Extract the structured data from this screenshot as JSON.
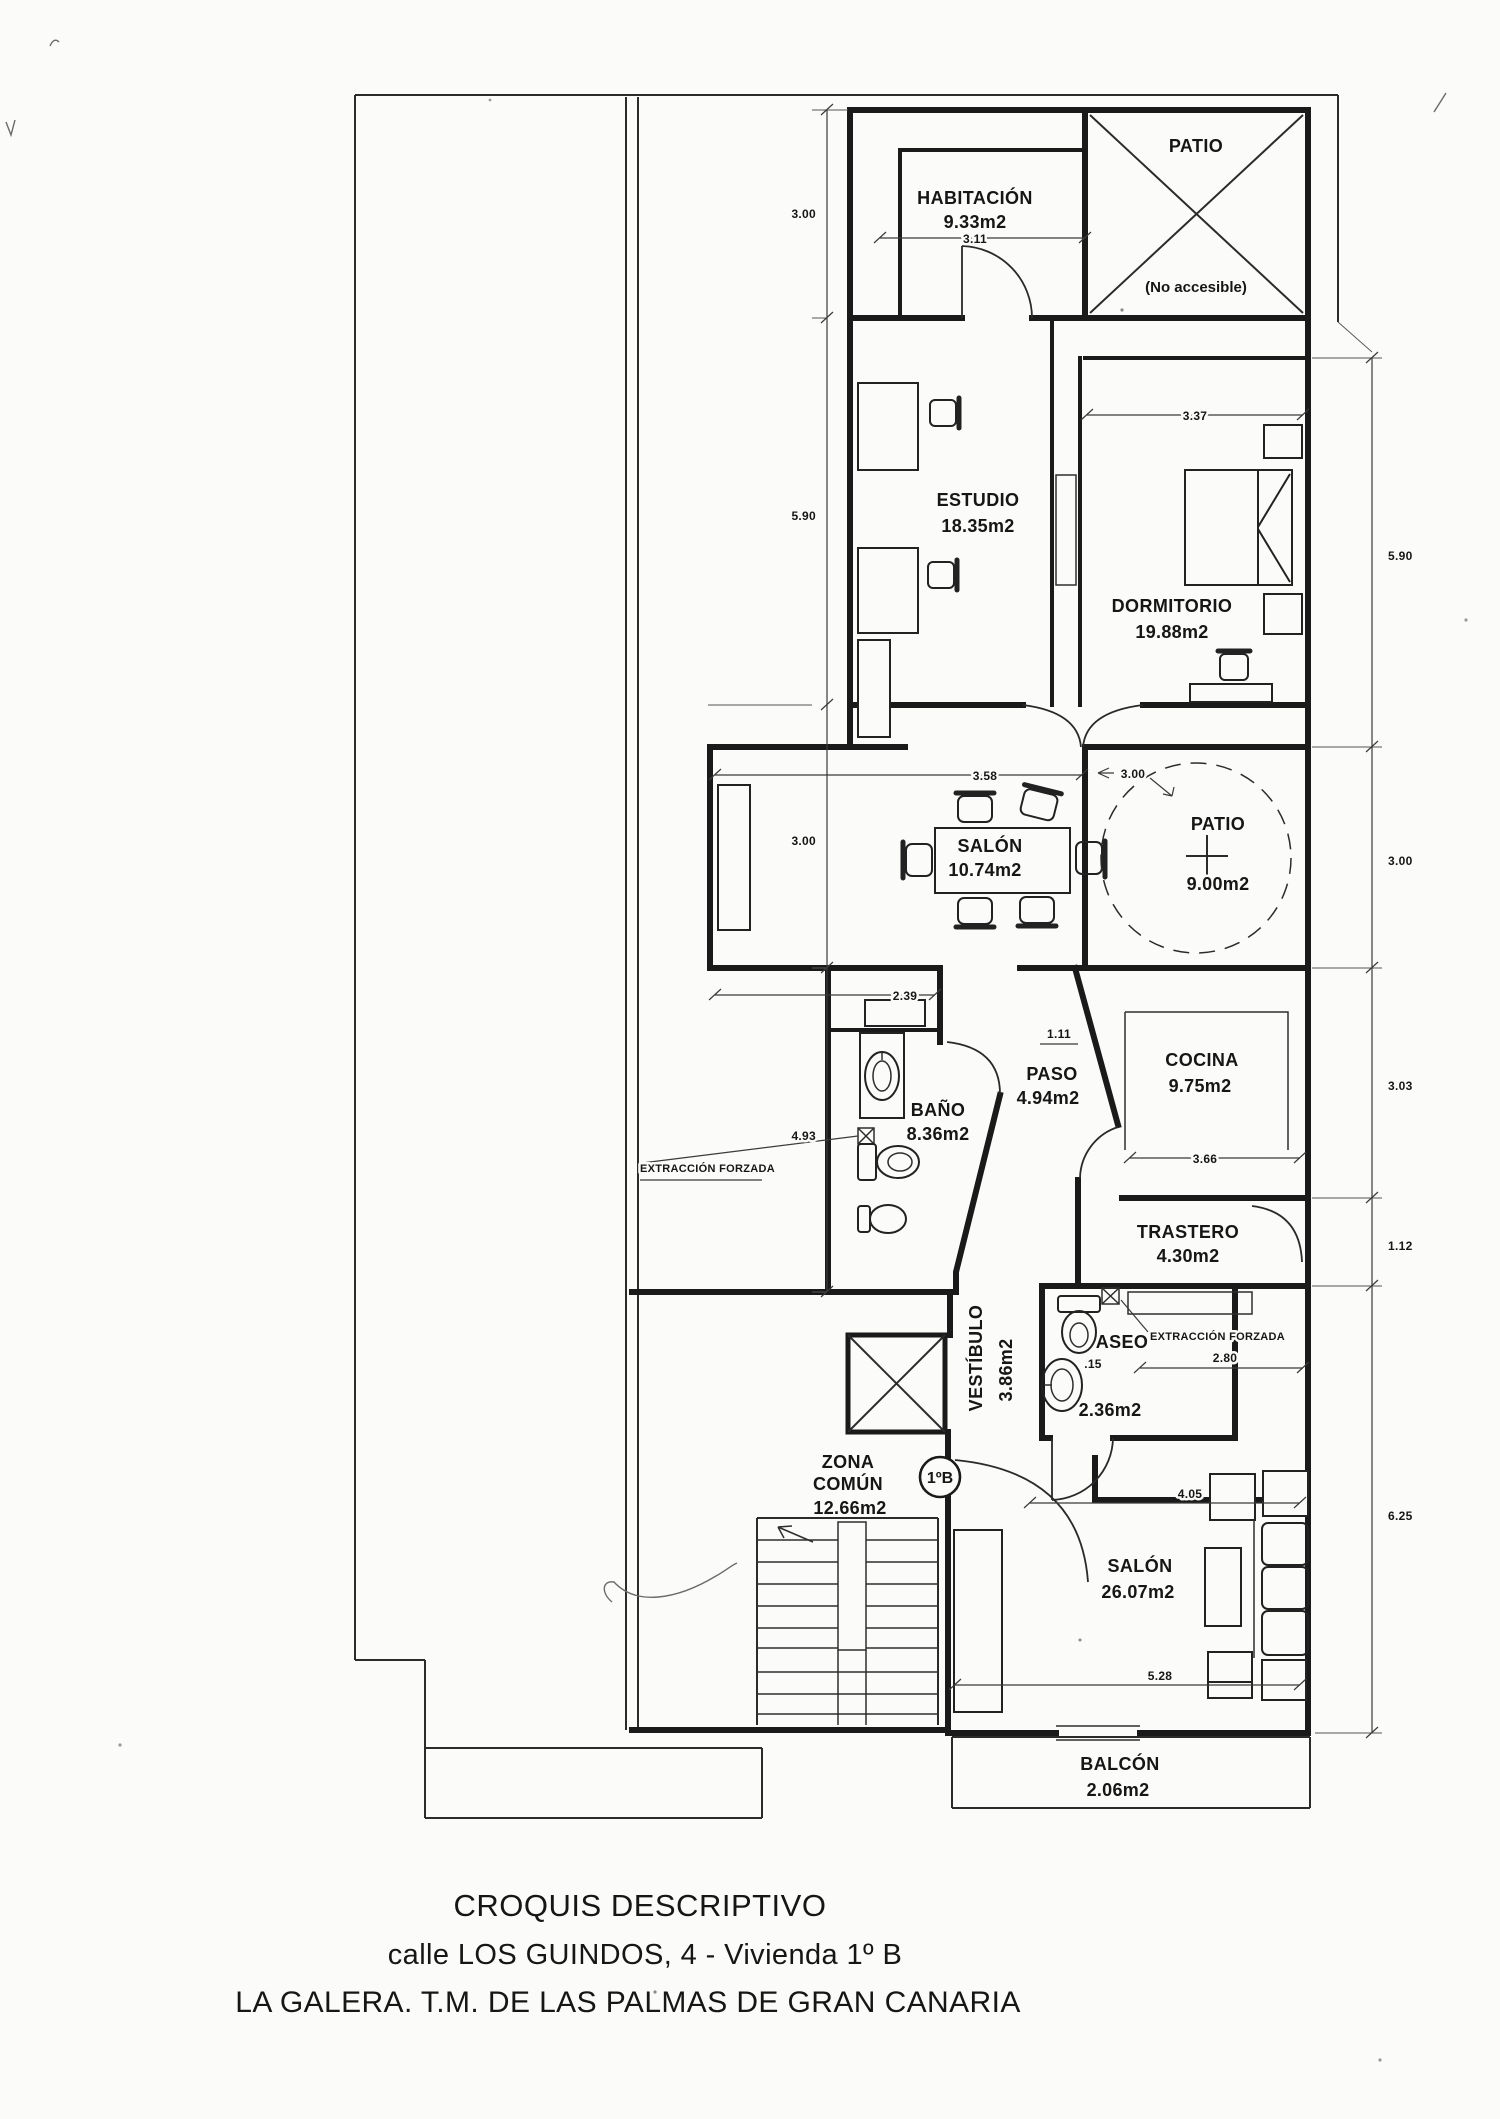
{
  "title": {
    "line1": "CROQUIS DESCRIPTIVO",
    "line2": "calle LOS GUINDOS, 4 - Vivienda 1º B",
    "line3": "LA GALERA. T.M. DE LAS PALMAS DE GRAN CANARIA"
  },
  "badge": "1ºB",
  "notes": {
    "no_accesible": "(No accesible)",
    "extraccion": "EXTRACCIÓN FORZADA"
  },
  "rooms": {
    "habitacion": {
      "name": "HABITACIÓN",
      "area": "9.33m2"
    },
    "patio_top": {
      "name": "PATIO"
    },
    "estudio": {
      "name": "ESTUDIO",
      "area": "18.35m2"
    },
    "dormitorio": {
      "name": "DORMITORIO",
      "area": "19.88m2"
    },
    "salon1": {
      "name": "SALÓN",
      "area": "10.74m2"
    },
    "patio2": {
      "name": "PATIO",
      "area": "9.00m2"
    },
    "bano": {
      "name": "BAÑO",
      "area": "8.36m2"
    },
    "paso": {
      "name": "PASO",
      "area": "4.94m2"
    },
    "cocina": {
      "name": "COCINA",
      "area": "9.75m2"
    },
    "trastero": {
      "name": "TRASTERO",
      "area": "4.30m2"
    },
    "aseo": {
      "name": "ASEO",
      "area": "2.36m2"
    },
    "vestibulo": {
      "name": "VESTÍBULO",
      "area": "3.86m2"
    },
    "zona_comun": {
      "line1": "ZONA",
      "line2": "COMÚN",
      "area": "12.66m2"
    },
    "salon2": {
      "name": "SALÓN",
      "area": "26.07m2"
    },
    "balcon": {
      "name": "BALCÓN",
      "area": "2.06m2"
    }
  },
  "dims": {
    "left1": "3.00",
    "left2": "5.90",
    "left3": "3.00",
    "left4": "4.93",
    "right1": "5.90",
    "right2": "3.00",
    "right3": "3.03",
    "right4": "1.12",
    "right5": "6.25",
    "hab": "3.11",
    "dorm": "3.37",
    "salon1": "3.58",
    "patio2": "3.00",
    "bano": "2.39",
    "paso": "1.11",
    "cocina": "3.66",
    "nook": "2.80",
    "aseo": ".15",
    "salon2a": "4.05",
    "salon2b": "5.28"
  }
}
